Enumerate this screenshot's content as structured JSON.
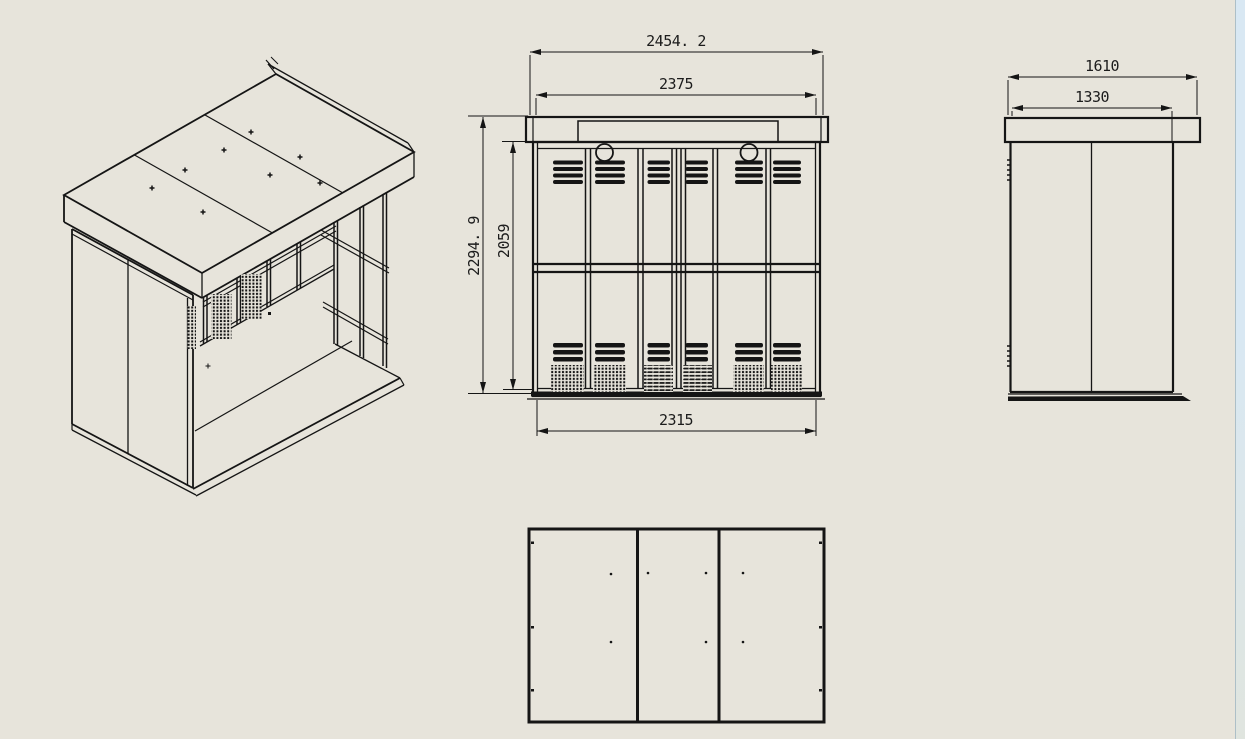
{
  "sheet": {
    "background_color": "#e7e4db",
    "line_color": "#151515"
  },
  "viewport_edge": {
    "top_color": "#d9e8f3",
    "bottom_color": "#e0e5df",
    "border_color": "#adbfc7"
  },
  "views": {
    "isometric": {
      "description": "isometric projection of enclosure"
    },
    "front": {
      "description": "front elevation with louver vents"
    },
    "side": {
      "description": "side elevation"
    },
    "bottom": {
      "description": "roof / bottom panel view, three panels"
    }
  },
  "dimensions": {
    "front_overall_width": "2454. 2",
    "front_inner_width": "2375",
    "front_overall_height": "2294. 9",
    "front_body_height": "2059",
    "front_base_width": "2315",
    "side_overall_depth": "1610",
    "side_inner_depth": "1330"
  }
}
